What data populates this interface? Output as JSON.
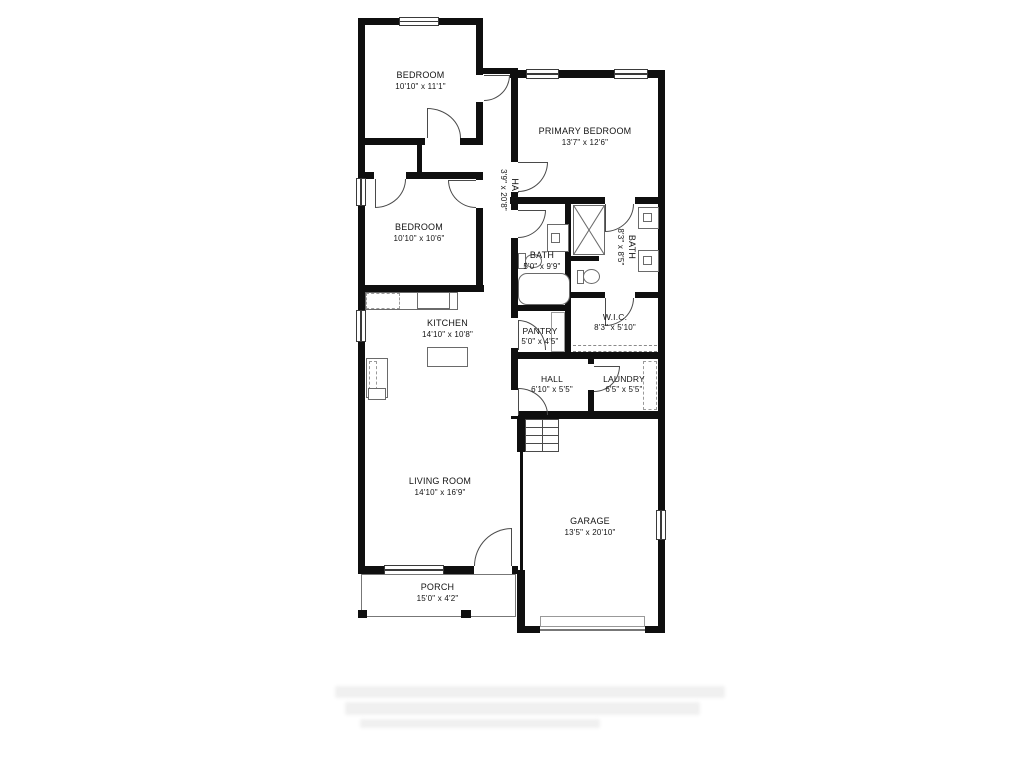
{
  "floor_plan": {
    "rooms": {
      "bedroom_top": {
        "name": "BEDROOM",
        "dims": "10'10\" x 11'1\""
      },
      "primary_bedroom": {
        "name": "PRIMARY BEDROOM",
        "dims": "13'7\" x 12'6\""
      },
      "hall_upper": {
        "name": "HALL",
        "dims": "3'9\" x 20'8\""
      },
      "bedroom_middle": {
        "name": "BEDROOM",
        "dims": "10'10\" x 10'6\""
      },
      "bath_hall": {
        "name": "BATH",
        "dims": "5'0\" x 9'9\""
      },
      "bath_primary": {
        "name": "BATH",
        "dims": "8'3\" x 8'5\""
      },
      "kitchen": {
        "name": "KITCHEN",
        "dims": "14'10\" x 10'8\""
      },
      "pantry": {
        "name": "PANTRY",
        "dims": "5'0\" x 4'5\""
      },
      "walk_in_closet": {
        "name": "W.I.C.",
        "dims": "8'3\" x 5'10\""
      },
      "hall_lower": {
        "name": "HALL",
        "dims": "6'10\" x 5'5\""
      },
      "laundry": {
        "name": "LAUNDRY",
        "dims": "6'5\" x 5'5\""
      },
      "living_room": {
        "name": "LIVING ROOM",
        "dims": "14'10\" x 16'9\""
      },
      "garage": {
        "name": "GARAGE",
        "dims": "13'5\" x 20'10\""
      },
      "porch": {
        "name": "PORCH",
        "dims": "15'0\" x 4'2\""
      }
    },
    "colors": {
      "wall": "#0f0f0f",
      "line": "#4a4a4a",
      "dash": "#9a9a9a"
    }
  }
}
